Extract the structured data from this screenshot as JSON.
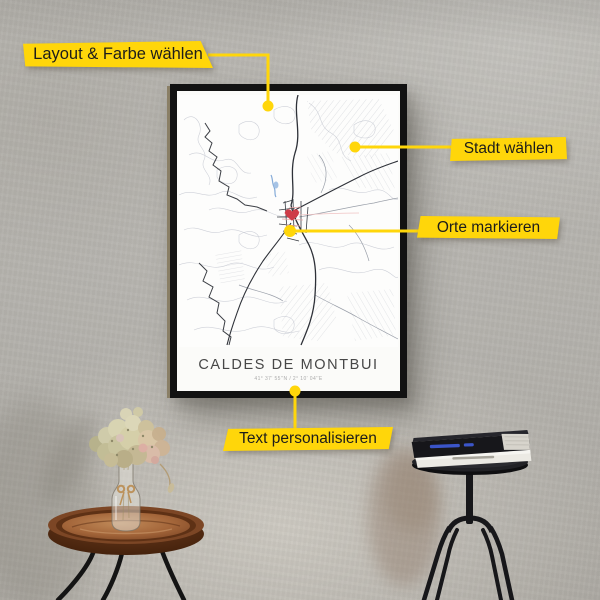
{
  "annotations": {
    "layout": {
      "label": "Layout & Farbe wählen"
    },
    "city": {
      "label": "Stadt wählen"
    },
    "places": {
      "label": "Orte markieren"
    },
    "text": {
      "label": "Text personalisieren"
    }
  },
  "poster": {
    "title": "CALDES DE MONTBUI",
    "coordinates": "41° 37' 55''N / 2° 10' 04''E"
  },
  "colors": {
    "callout_bg": "#FFD60A",
    "callout_text": "#1D1D1B",
    "anchor_dot": "#FFD60A",
    "heart_marker": "#CE3C47",
    "frame": "#121212",
    "poster_bg": "#FBFBF9",
    "wall": "#B8B6B1"
  },
  "icons": [
    {
      "name": "heart-marker-icon",
      "glyph": "♥"
    },
    {
      "name": "anchor-dot",
      "glyph": "●"
    }
  ]
}
